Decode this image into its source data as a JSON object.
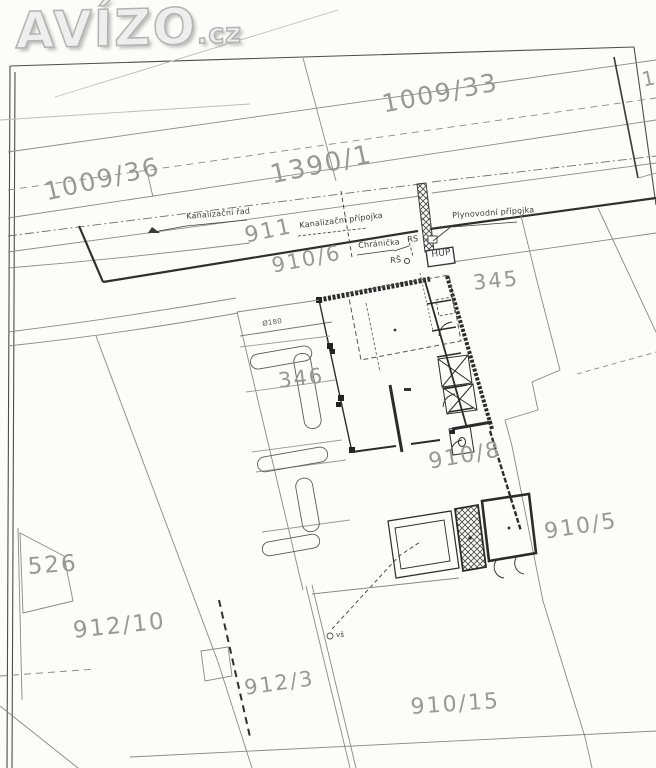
{
  "watermark": {
    "brand": "AVÍZO",
    "tld": ".cz"
  },
  "parcel_labels": {
    "p1009_33": "1009/33",
    "p1009_36": "1009/36",
    "p1390_1": "1390/1",
    "p911": "911",
    "p910_6": "910/6",
    "p345": "345",
    "p346": "346",
    "p910_8": "910/8",
    "p910_5": "910/5",
    "p526": "526",
    "p912_10": "912/10",
    "p912_3": "912/3",
    "p910_15": "910/15",
    "p_edge_partial": "10"
  },
  "utility_labels": {
    "sewer_main": "Kanalizační řad",
    "sewer_service": "Kanalizační přípojka",
    "gas_service": "Plynovodní přípojka",
    "casing": "Chránička",
    "rs": "RS",
    "inspection_shaft": "RŠ",
    "gas_main_valve": "HUP",
    "pipe_diameter": "Ø180",
    "water_meter_shaft": "vš"
  },
  "colors": {
    "paper": "#fcfcfb",
    "line_dark": "#2e2e2e",
    "line_gray": "#8a8a8a",
    "label_gray": "#989898",
    "watermark": "#eeeeee"
  }
}
